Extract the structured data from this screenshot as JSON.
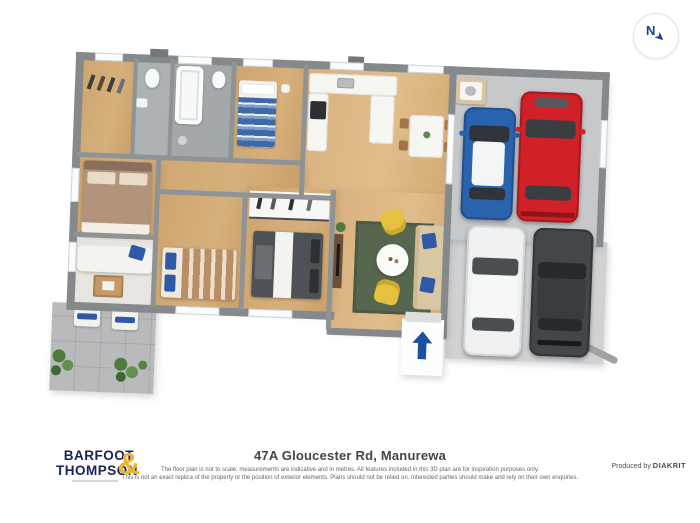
{
  "compass": {
    "letter": "N"
  },
  "footer": {
    "logo": {
      "line1": "BARFOOT",
      "line2": "THOMPSON",
      "ampersand": "&"
    },
    "address": "47A Gloucester Rd, Manurewa",
    "disclaimer_line1": "The floor plan is not to scale: measurements are indicative and in metres. All features included in this 3D plan are for inspiration purposes only.",
    "disclaimer_line2": "This is not an exact replica of the property or the position of exterior elements. Plans should not be relied on. Interested parties should make and rely on their own enquiries.",
    "produced_by": "Produced by",
    "producer": "DIAKRIT"
  },
  "colors": {
    "logo_navy": "#15245b",
    "logo_yellow": "#f2b32b",
    "wall_gray": "#85898c",
    "wood_floor": "#d2a971",
    "tile_floor": "#a3a8ab",
    "garage_floor": "#c6c8ca",
    "driveway": "#cfd1d3",
    "patio_pavers": "#d9dadb",
    "rug_green": "#57664f",
    "armchair_yellow": "#e4c23d",
    "accent_blue": "#2a55a4",
    "car_blue": "#2a63ad",
    "car_red": "#cf2127",
    "car_white": "#eef0f1",
    "car_dark": "#43474c",
    "entry_arrow": "#1d4fa1"
  }
}
